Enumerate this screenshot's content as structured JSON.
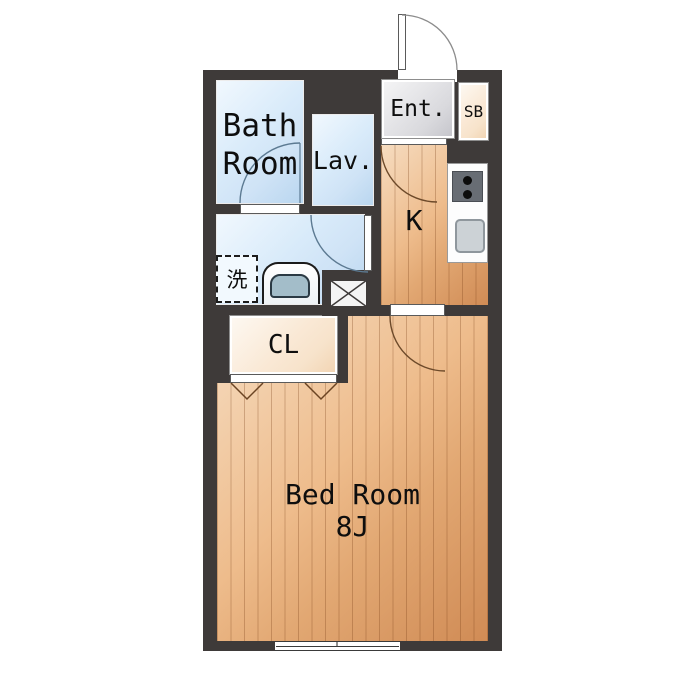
{
  "labels": {
    "bath_line1": "Bath",
    "bath_line2": "Room",
    "lavatory": "Lav.",
    "entrance": "Ent.",
    "shoe_box": "SB",
    "kitchen": "K",
    "closet": "CL",
    "bedroom_name": "Bed Room",
    "bedroom_size": "8J",
    "laundry": "洗"
  },
  "colors": {
    "background": "#ffffff",
    "wall": "#3e3a39",
    "water_floor": "#cfe3f6",
    "wood_floor": "#e2a873",
    "entrance_floor": "#d9d9dd",
    "closet_floor": "#f7e3cb"
  }
}
